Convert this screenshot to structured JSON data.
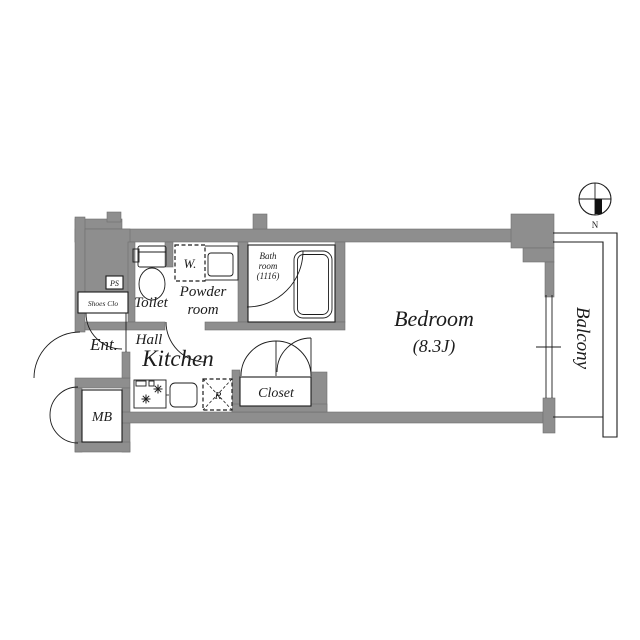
{
  "floor_plan": {
    "rooms": {
      "bedroom": {
        "name": "Bedroom",
        "size": "(8.3J)"
      },
      "balcony": {
        "name": "Balcony"
      },
      "kitchen": {
        "name": "Kitchen"
      },
      "hall": {
        "name": "Hall"
      },
      "entrance": {
        "name": "Ent."
      },
      "toilet": {
        "name": "Toilet"
      },
      "powder_room": {
        "line1": "Powder",
        "line2": "room"
      },
      "bath_room": {
        "line1": "Bath",
        "line2": "room",
        "line3": "(1116)"
      },
      "closet": {
        "name": "Closet"
      },
      "meter_box": {
        "name": "MB"
      },
      "shoes_closet": {
        "name": "Shoes Clo"
      },
      "pipe_space": {
        "name": "PS"
      }
    },
    "fixtures": {
      "washer_label": "W.",
      "refrigerator_label": "R"
    },
    "compass": {
      "north_label": "N"
    },
    "colors": {
      "wall": "#8e8e8e",
      "line": "#1c1c1c",
      "background": "#ffffff"
    }
  }
}
